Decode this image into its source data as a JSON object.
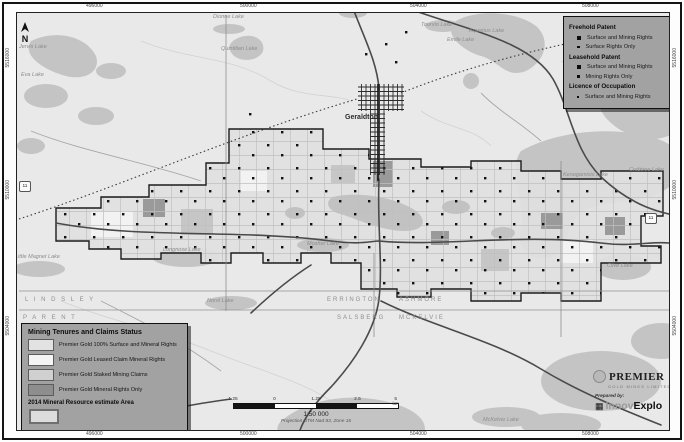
{
  "north_arrow": {
    "label": "N"
  },
  "highway_shield": {
    "label": "11"
  },
  "places": [
    {
      "id": "jervis-lake",
      "text": "Jervis Lake",
      "x": 18,
      "y": 44,
      "cls": "water"
    },
    {
      "id": "eva-lake",
      "text": "Eva Lake",
      "x": 20,
      "y": 72,
      "cls": "water"
    },
    {
      "id": "dionne-lake",
      "text": "Dionne Lake",
      "x": 212,
      "y": 14,
      "cls": "water"
    },
    {
      "id": "quintilian-lake",
      "text": "Quintilian Lake",
      "x": 220,
      "y": 46,
      "cls": "water"
    },
    {
      "id": "currie-lake",
      "text": "Currie Lake",
      "x": 338,
      "y": 8,
      "cls": "water"
    },
    {
      "id": "tourvio-lake",
      "text": "Tourvio Lake",
      "x": 420,
      "y": 22,
      "cls": "water"
    },
    {
      "id": "emile-lake",
      "text": "Emile Lake",
      "x": 446,
      "y": 37,
      "cls": "water"
    },
    {
      "id": "aquarius-lake",
      "text": "Aquarius Lake",
      "x": 468,
      "y": 28,
      "cls": "water"
    },
    {
      "id": "geraldton",
      "text": "Geraldton",
      "x": 344,
      "y": 113,
      "cls": "town"
    },
    {
      "id": "kenogamisis-lake",
      "text": "Kenogamisis Lake",
      "x": 562,
      "y": 172,
      "cls": "water"
    },
    {
      "id": "crabtree-lake",
      "text": "Crabtree Lake",
      "x": 628,
      "y": 167,
      "cls": "water"
    },
    {
      "id": "clive-lake",
      "text": "Clive Lake",
      "x": 606,
      "y": 263,
      "cls": "water"
    },
    {
      "id": "little-magnet-lake",
      "text": "Little Magnet Lake",
      "x": 14,
      "y": 254,
      "cls": "water"
    },
    {
      "id": "longnose-lake",
      "text": "Longnose Lake",
      "x": 162,
      "y": 247,
      "cls": "water"
    },
    {
      "id": "mosher-lake",
      "text": "Mosher Lake",
      "x": 306,
      "y": 241,
      "cls": "water"
    },
    {
      "id": "norol-lake",
      "text": "Norol Lake",
      "x": 206,
      "y": 298,
      "cls": "water"
    },
    {
      "id": "mckelvie-lake",
      "text": "McKelvie Lake",
      "x": 482,
      "y": 417,
      "cls": "water"
    },
    {
      "id": "twp-lindsley",
      "text": "L I N D S L E Y",
      "x": 24,
      "y": 296,
      "cls": "twp"
    },
    {
      "id": "twp-parent",
      "text": "P A R E N T",
      "x": 22,
      "y": 314,
      "cls": "twp"
    },
    {
      "id": "twp-errington",
      "text": "ERRINGTON",
      "x": 326,
      "y": 296,
      "cls": "twp"
    },
    {
      "id": "twp-ashmore",
      "text": "ASHMORE",
      "x": 398,
      "y": 296,
      "cls": "twp"
    },
    {
      "id": "twp-salsberg",
      "text": "SALSBERG",
      "x": 336,
      "y": 314,
      "cls": "twp"
    },
    {
      "id": "twp-mckelvie",
      "text": "MCKELVIE",
      "x": 398,
      "y": 314,
      "cls": "twp"
    }
  ],
  "coordinates": {
    "top": [
      {
        "text": "496000",
        "x": 86
      },
      {
        "text": "500000",
        "x": 240
      },
      {
        "text": "504000",
        "x": 410
      },
      {
        "text": "508000",
        "x": 582
      }
    ],
    "bottom": [
      {
        "text": "496000",
        "x": 86
      },
      {
        "text": "500000",
        "x": 240
      },
      {
        "text": "504000",
        "x": 410
      },
      {
        "text": "508000",
        "x": 582
      }
    ],
    "left": [
      {
        "text": "5516000",
        "y": 48
      },
      {
        "text": "5510000",
        "y": 180
      },
      {
        "text": "5504000",
        "y": 316
      }
    ],
    "right": [
      {
        "text": "5516000",
        "y": 48
      },
      {
        "text": "5510000",
        "y": 180
      },
      {
        "text": "5504000",
        "y": 316
      }
    ]
  },
  "tenure_legend": {
    "sections": [
      {
        "title": "Freehold Patent",
        "items": [
          {
            "label": "Surface and Mining Rights",
            "marker": "square-md"
          },
          {
            "label": "Surface Rights Only",
            "marker": "square-sm"
          }
        ]
      },
      {
        "title": "Leasehold Patent",
        "items": [
          {
            "label": "Surface and Mining Rights",
            "marker": "square-md"
          },
          {
            "label": "Mining Rights Only",
            "marker": "square-sm"
          }
        ]
      },
      {
        "title": "Licence of Occupation",
        "items": [
          {
            "label": "Surface and Mining Rights",
            "marker": "dot"
          }
        ]
      }
    ]
  },
  "status_legend": {
    "title": "Mining Tenures and Claims Status",
    "items": [
      {
        "label": "Premier Gold 100% Surface and Mineral Rights",
        "swatch": "#e2e2e2"
      },
      {
        "label": "Premier Gold Leased Claim Mineral Rights",
        "swatch": "#f5f5f5"
      },
      {
        "label": "Premier Gold Staked Mining Claims",
        "swatch": "#d0d0d0"
      },
      {
        "label": "Premier Gold Mineral Rights Only",
        "swatch": "#8e8e8e"
      }
    ],
    "resource_area": {
      "label": "2014 Mineral Resource estimate Area"
    }
  },
  "scale": {
    "ratio": "1:50 000",
    "projection": "Projection UTM Nad 83, Zone 16",
    "ticks": [
      "1.25",
      "0",
      "1.25",
      "2.5",
      "5 km"
    ]
  },
  "credits": {
    "premier": "PREMIER",
    "premier_sub": "GOLD MINES LIMITED",
    "prepared_by": "Prepared by:",
    "innovexplo_a": "Innov",
    "innovexplo_b": "Explo"
  },
  "colors": {
    "water": "#c4c4c4",
    "claims_fill": "#dfdfdf",
    "claims_outline": "#1c1c1c",
    "legend_bg": "#a2a2a2",
    "mineral_rights_only": "#8e8e8e"
  }
}
